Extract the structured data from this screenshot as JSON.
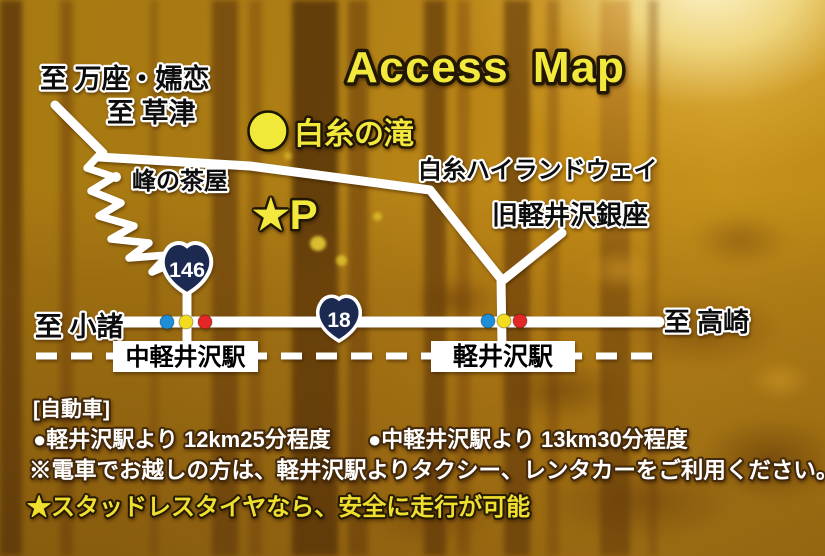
{
  "title": "Access Map",
  "map": {
    "to_manza_tsumagoi": "至 万座・嬬恋",
    "to_kusatsu": "至 草津",
    "shiraito_falls": "白糸の滝",
    "mine_no_chaya": "峰の茶屋",
    "shiraito_highland_way": "白糸ハイランドウェイ",
    "kyu_karuizawa_ginza": "旧軽井沢銀座",
    "parking": "★P",
    "route_146": "146",
    "route_18": "18",
    "to_komoro": "至 小諸",
    "to_takasaki": "至 高崎",
    "naka_karuizawa_station": "中軽井沢駅",
    "karuizawa_station": "軽井沢駅"
  },
  "notes": {
    "car_heading": "[自動車]",
    "from_karuizawa": "●軽井沢駅より 12km25分程度",
    "from_naka_karuizawa": "●中軽井沢駅より 13km30分程度",
    "train_note": "※電車でお越しの方は、軽井沢駅よりタクシー、レンタカーをご利用ください。",
    "tire_note": "★スタッドレスタイヤなら、安全に走行が可能"
  },
  "colors": {
    "accent_yellow": "#f2e93c",
    "road_white": "#ffffff",
    "route_shield_navy": "#1c2a52",
    "signal_blue": "#1f8ed8",
    "signal_yellow": "#f3dc20",
    "signal_red": "#e32726",
    "background_gold": "#b98619"
  }
}
